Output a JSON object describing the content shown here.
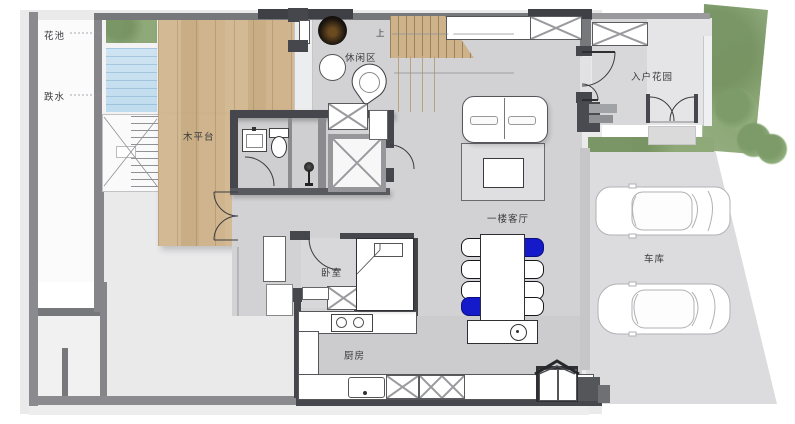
{
  "plan": {
    "rooms": {
      "flower_bed": "花池",
      "waterfall": "跌水",
      "wood_deck": "木平台",
      "leisure_area": "休闲区",
      "entry_garden": "入户花园",
      "living_room": "一楼客厅",
      "bedroom": "卧室",
      "kitchen": "厨房",
      "garage": "车库"
    },
    "annotations": {
      "stairs_up": "上"
    },
    "colors": {
      "wall_gray": "#77787c",
      "wall_dark": "#46474c",
      "interior_floor": "#d2d2d4",
      "exterior_slab": "#eaeaeb",
      "wood_deck": "#ceb189",
      "water_blue": "#c3ddee",
      "planting_green": "#94ae81",
      "accent_chair_blue": "#1419c9"
    },
    "dining": {
      "chairs_left": [
        "white",
        "white",
        "white",
        "blue"
      ],
      "chairs_right": [
        "blue",
        "white",
        "white",
        "white"
      ]
    },
    "garage": {
      "car_count": 2
    }
  }
}
